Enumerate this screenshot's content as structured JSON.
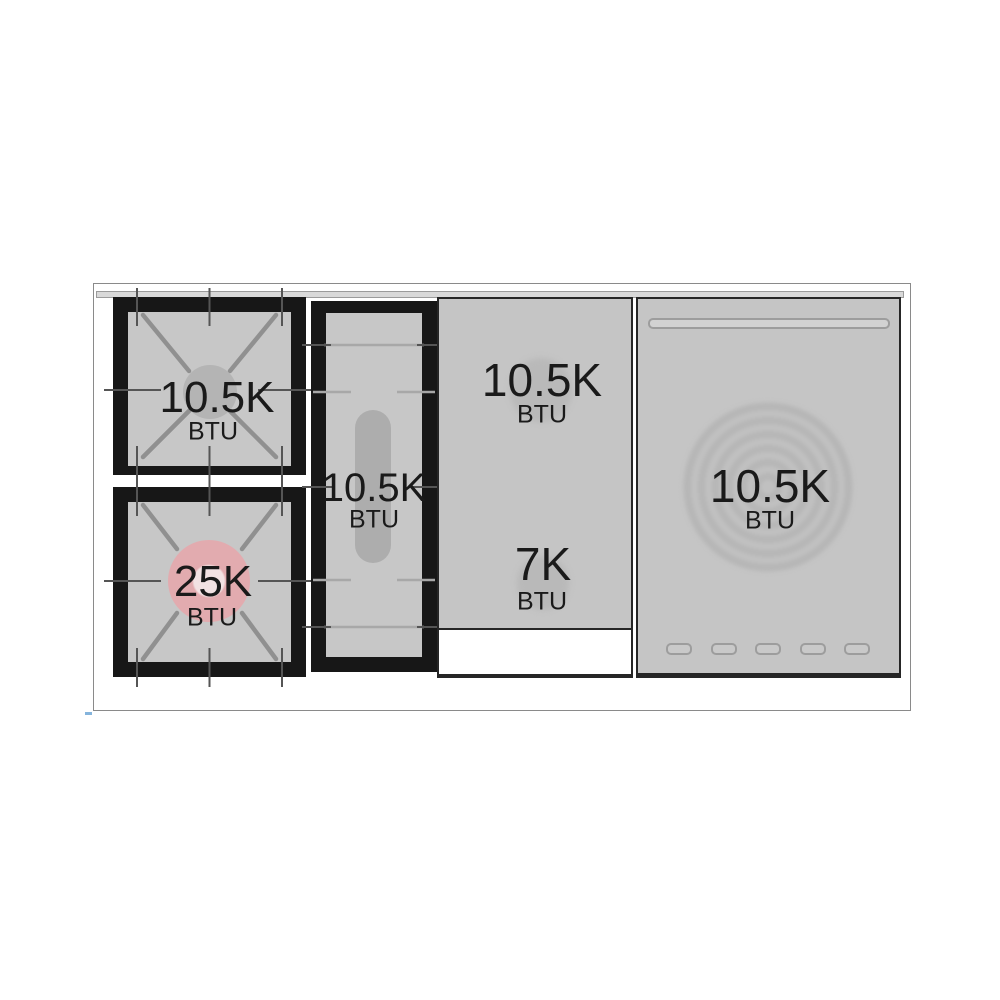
{
  "diagram": {
    "name": "rangetop-btu-diagram",
    "unit_label": "BTU"
  },
  "burners": [
    {
      "id": "left-top-burner",
      "value": "10.5K",
      "unit": "BTU"
    },
    {
      "id": "left-bottom-burner",
      "value": "25K",
      "unit": "BTU"
    },
    {
      "id": "center-griddle-burner",
      "value": "10.5K",
      "unit": "BTU"
    },
    {
      "id": "griddle-top-burner",
      "value": "10.5K",
      "unit": "BTU"
    },
    {
      "id": "griddle-bottom-burner",
      "value": "7K",
      "unit": "BTU"
    },
    {
      "id": "french-top-burner",
      "value": "10.5K",
      "unit": "BTU"
    }
  ],
  "colors": {
    "grate_black": "#171717",
    "surface_gray": "#c5c5c5",
    "burner_cap_gray": "#b4b4b4",
    "accent_pink": "#e2abaf",
    "trim_gray": "#d9d9d9",
    "frame_border": "#8a8a8a"
  }
}
